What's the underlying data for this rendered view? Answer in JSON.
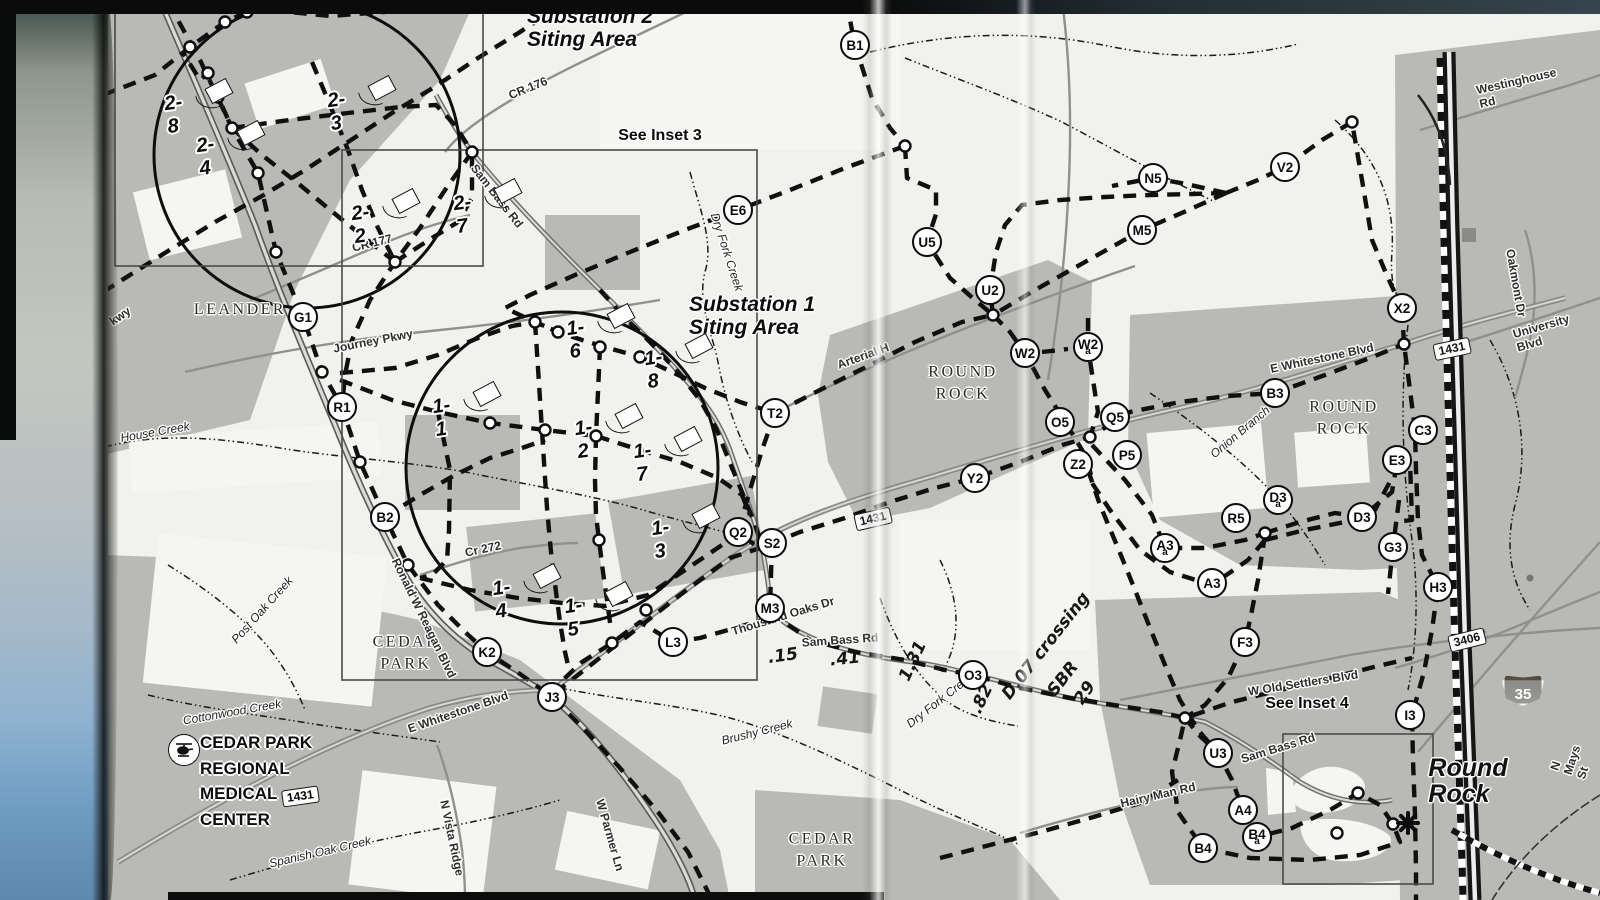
{
  "map": {
    "ink_color": "#111111",
    "urban_gray": "#b9bab6",
    "paper_color": "#f1f1ee",
    "nodes": [
      {
        "id": "B1",
        "x": 855,
        "y": 45
      },
      {
        "id": "E6",
        "x": 738,
        "y": 210
      },
      {
        "id": "U5",
        "x": 927,
        "y": 242
      },
      {
        "id": "N5",
        "x": 1153,
        "y": 178
      },
      {
        "id": "M5",
        "x": 1142,
        "y": 230
      },
      {
        "id": "V2",
        "x": 1285,
        "y": 167
      },
      {
        "id": "U2",
        "x": 990,
        "y": 290
      },
      {
        "id": "X2",
        "x": 1402,
        "y": 308
      },
      {
        "id": "W2",
        "x": 1025,
        "y": 353
      },
      {
        "id": "W2",
        "sub": "a",
        "x": 1088,
        "y": 347
      },
      {
        "id": "G1",
        "x": 303,
        "y": 317
      },
      {
        "id": "R1",
        "x": 342,
        "y": 407
      },
      {
        "id": "T2",
        "x": 775,
        "y": 413
      },
      {
        "id": "O5",
        "x": 1060,
        "y": 422
      },
      {
        "id": "Q5",
        "x": 1115,
        "y": 417
      },
      {
        "id": "Z2",
        "x": 1078,
        "y": 464
      },
      {
        "id": "P5",
        "x": 1127,
        "y": 455
      },
      {
        "id": "B3",
        "x": 1275,
        "y": 393
      },
      {
        "id": "C3",
        "x": 1423,
        "y": 430
      },
      {
        "id": "E3",
        "x": 1397,
        "y": 460
      },
      {
        "id": "Y2",
        "x": 975,
        "y": 478
      },
      {
        "id": "B2",
        "x": 385,
        "y": 517
      },
      {
        "id": "Q2",
        "x": 738,
        "y": 532
      },
      {
        "id": "S2",
        "x": 772,
        "y": 543
      },
      {
        "id": "D3",
        "sub": "a",
        "x": 1278,
        "y": 500
      },
      {
        "id": "R5",
        "x": 1236,
        "y": 518
      },
      {
        "id": "D3",
        "x": 1362,
        "y": 517
      },
      {
        "id": "A3",
        "sub": "a",
        "x": 1165,
        "y": 548
      },
      {
        "id": "A3",
        "x": 1212,
        "y": 583
      },
      {
        "id": "G3",
        "x": 1393,
        "y": 547
      },
      {
        "id": "H3",
        "x": 1438,
        "y": 587
      },
      {
        "id": "M3",
        "x": 770,
        "y": 608
      },
      {
        "id": "L3",
        "x": 673,
        "y": 642
      },
      {
        "id": "K2",
        "x": 487,
        "y": 652
      },
      {
        "id": "O3",
        "x": 973,
        "y": 675
      },
      {
        "id": "F3",
        "x": 1245,
        "y": 642
      },
      {
        "id": "J3",
        "x": 552,
        "y": 697
      },
      {
        "id": "I3",
        "x": 1410,
        "y": 715
      },
      {
        "id": "U3",
        "x": 1218,
        "y": 753
      },
      {
        "id": "A4",
        "x": 1243,
        "y": 810
      },
      {
        "id": "B4",
        "sub": "a",
        "x": 1257,
        "y": 837
      },
      {
        "id": "B4",
        "x": 1203,
        "y": 848
      }
    ],
    "sites": [
      {
        "id": "2-8",
        "x": 175,
        "y": 115
      },
      {
        "id": "2-3",
        "x": 338,
        "y": 112
      },
      {
        "id": "2-4",
        "x": 207,
        "y": 157
      },
      {
        "id": "2-2",
        "x": 362,
        "y": 225
      },
      {
        "id": "2-7",
        "x": 464,
        "y": 215
      },
      {
        "id": "1-6",
        "x": 577,
        "y": 340
      },
      {
        "id": "1-8",
        "x": 655,
        "y": 370
      },
      {
        "id": "1-1",
        "x": 443,
        "y": 418
      },
      {
        "id": "1-2",
        "x": 585,
        "y": 440
      },
      {
        "id": "1-7",
        "x": 644,
        "y": 463
      },
      {
        "id": "1-3",
        "x": 662,
        "y": 540
      },
      {
        "id": "1-4",
        "x": 503,
        "y": 600
      },
      {
        "id": "1-5",
        "x": 575,
        "y": 618
      }
    ],
    "labels": [
      {
        "t": "Substation 2\nSiting Area",
        "x": 590,
        "y": 28,
        "r": 0,
        "cls": "title"
      },
      {
        "t": "Substation 1\nSiting Area",
        "x": 752,
        "y": 316,
        "r": 0,
        "cls": "title"
      },
      {
        "t": "See Inset 3",
        "x": 660,
        "y": 136,
        "r": 0,
        "cls": "inset"
      },
      {
        "t": "See Inset 4",
        "x": 1307,
        "y": 704,
        "r": 0,
        "cls": "inset"
      },
      {
        "t": "LEANDER",
        "x": 240,
        "y": 310,
        "r": 0,
        "cls": "city"
      },
      {
        "t": "ROUND\nROCK",
        "x": 963,
        "y": 383,
        "r": 0,
        "cls": "city"
      },
      {
        "t": "ROUND\nROCK",
        "x": 1344,
        "y": 418,
        "r": 0,
        "cls": "city"
      },
      {
        "t": "CEDAR\nPARK",
        "x": 406,
        "y": 653,
        "r": 0,
        "cls": "city"
      },
      {
        "t": "CEDAR\nPARK",
        "x": 822,
        "y": 850,
        "r": 0,
        "cls": "city"
      },
      {
        "t": "Round\nRock",
        "x": 1468,
        "y": 781,
        "r": 0,
        "cls": "bigcity"
      },
      {
        "t": "CR 176",
        "x": 528,
        "y": 88,
        "r": -22,
        "cls": "road"
      },
      {
        "t": "Sam Bass Rd",
        "x": 497,
        "y": 196,
        "r": 52,
        "cls": "road"
      },
      {
        "t": "CR 177",
        "x": 372,
        "y": 243,
        "r": -14,
        "cls": "road"
      },
      {
        "t": "Journey Pkwy",
        "x": 373,
        "y": 341,
        "r": -11,
        "cls": "road"
      },
      {
        "t": "kwy",
        "x": 120,
        "y": 316,
        "r": -35,
        "cls": "road"
      },
      {
        "t": "Arterial H",
        "x": 863,
        "y": 356,
        "r": -20,
        "cls": "road"
      },
      {
        "t": "E Whitestone Blvd",
        "x": 1322,
        "y": 358,
        "r": -12,
        "cls": "road"
      },
      {
        "t": "University Blvd",
        "x": 1543,
        "y": 333,
        "r": -16,
        "cls": "road"
      },
      {
        "t": "Westinghouse Rd",
        "x": 1518,
        "y": 88,
        "r": -13,
        "cls": "road"
      },
      {
        "t": "Oakmont Dr",
        "x": 1516,
        "y": 283,
        "r": 80,
        "cls": "road"
      },
      {
        "t": "Cr 272",
        "x": 483,
        "y": 549,
        "r": -12,
        "cls": "road"
      },
      {
        "t": "Ronald W Reagan Blvd",
        "x": 424,
        "y": 618,
        "r": 64,
        "cls": "road"
      },
      {
        "t": "E Whitestone Blvd",
        "x": 458,
        "y": 712,
        "r": -19,
        "cls": "road"
      },
      {
        "t": "N Vista Ridge",
        "x": 452,
        "y": 838,
        "r": 78,
        "cls": "road"
      },
      {
        "t": "W Parmer Ln",
        "x": 610,
        "y": 835,
        "r": 74,
        "cls": "road"
      },
      {
        "t": "Thousand Oaks Dr",
        "x": 783,
        "y": 616,
        "r": -17,
        "cls": "road"
      },
      {
        "t": "Sam Bass   Rd",
        "x": 840,
        "y": 640,
        "r": -4,
        "cls": "road"
      },
      {
        "t": "W Old Settlers Blvd",
        "x": 1303,
        "y": 683,
        "r": -9,
        "cls": "road"
      },
      {
        "t": "Hairy Man Rd",
        "x": 1158,
        "y": 795,
        "r": -13,
        "cls": "road"
      },
      {
        "t": "Sam Bass Rd",
        "x": 1278,
        "y": 748,
        "r": -17,
        "cls": "road"
      },
      {
        "t": "N Mays St",
        "x": 1572,
        "y": 760,
        "r": -72,
        "cls": "road"
      },
      {
        "t": "Dry Fork Creek",
        "x": 727,
        "y": 252,
        "r": 72,
        "cls": "creek"
      },
      {
        "t": "House Creek",
        "x": 155,
        "y": 432,
        "r": -10,
        "cls": "creek"
      },
      {
        "t": "Post Oak Creek",
        "x": 262,
        "y": 610,
        "r": -48,
        "cls": "creek"
      },
      {
        "t": "Cottonwood Creek",
        "x": 232,
        "y": 712,
        "r": -10,
        "cls": "creek"
      },
      {
        "t": "Spanish Oak Creek",
        "x": 320,
        "y": 852,
        "r": -13,
        "cls": "creek"
      },
      {
        "t": "Brushy Creek",
        "x": 757,
        "y": 732,
        "r": -14,
        "cls": "creek"
      },
      {
        "t": "Dry Fork Creek",
        "x": 940,
        "y": 700,
        "r": -38,
        "cls": "creek"
      },
      {
        "t": "Onion Branch",
        "x": 1240,
        "y": 432,
        "r": -40,
        "cls": "creek"
      },
      {
        "t": "1431",
        "x": 873,
        "y": 519,
        "r": -13,
        "cls": "shield"
      },
      {
        "t": "1431",
        "x": 1452,
        "y": 349,
        "r": -12,
        "cls": "shield"
      },
      {
        "t": "3406",
        "x": 1467,
        "y": 640,
        "r": -14,
        "cls": "shield"
      },
      {
        "t": ".15",
        "x": 783,
        "y": 656,
        "r": -8,
        "cls": "hand"
      },
      {
        "t": ".41",
        "x": 845,
        "y": 659,
        "r": -6,
        "cls": "hand"
      },
      {
        "t": "1.31",
        "x": 913,
        "y": 661,
        "r": -65,
        "cls": "hand"
      },
      {
        "t": ".82",
        "x": 982,
        "y": 699,
        "r": -65,
        "cls": "hand"
      },
      {
        "t": "D.07 crossing",
        "x": 1046,
        "y": 646,
        "r": -52,
        "cls": "hand"
      },
      {
        "t": "SBR",
        "x": 1063,
        "y": 679,
        "r": -52,
        "cls": "hand"
      },
      {
        "t": "29",
        "x": 1085,
        "y": 693,
        "r": -56,
        "cls": "hand"
      }
    ],
    "interstate_shield": {
      "number": "35",
      "x": 1523,
      "y": 688
    },
    "medical_center": {
      "text": "CEDAR PARK\nREGIONAL\nMEDICAL\nCENTER",
      "shield": "1431",
      "x": 200,
      "y": 730,
      "heli_x": 168,
      "heli_y": 734
    },
    "asterisk": {
      "x": 1408,
      "y": 823
    }
  }
}
